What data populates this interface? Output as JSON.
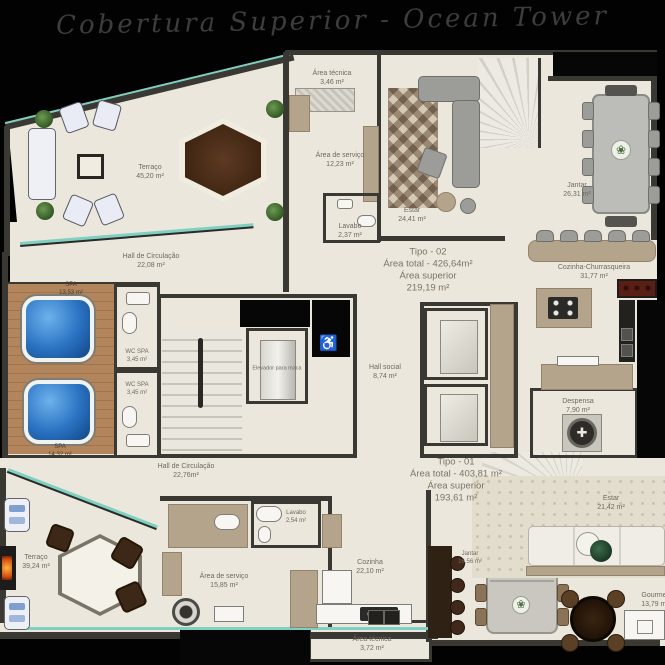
{
  "title": "Cobertura Superior - Ocean Tower",
  "colors": {
    "background": "#000000",
    "floor": "#ebe7dc",
    "wall": "#3a3833",
    "wood_deck": "#ab7c52",
    "spa_water": "#2a72c2",
    "glass": "#7fd0c0",
    "furniture_tan": "#b5a48c"
  },
  "unit_blocks": {
    "tipo02": {
      "line1": "Tipo - 02",
      "line2": "Área total - 426,64m²",
      "line3": "Área superior",
      "line4": "219,19 m²"
    },
    "tipo01": {
      "line1": "Tipo - 01",
      "line2": "Área total - 403,81 m²",
      "line3": "Área superior",
      "line4": "193,61 m²"
    }
  },
  "rooms": {
    "terraco_sup": {
      "label": "Terraço",
      "area": "45,20 m²"
    },
    "area_tecnica_sup": {
      "label": "Área técnica",
      "area": "3,46 m²"
    },
    "area_servico_sup": {
      "label": "Área de serviço",
      "area": "12,23 m²"
    },
    "lavabo_sup": {
      "label": "Lavabo",
      "area": "2,37 m²"
    },
    "estar_sup": {
      "label": "Estar",
      "area": "24,41 m²"
    },
    "jantar_sup": {
      "label": "Jantar",
      "area": "26,31 m²"
    },
    "cozinha_churrasqueira": {
      "label": "Cozinha-Churrasqueira",
      "area": "31,77 m²"
    },
    "hall_circulacao_sup": {
      "label": "Hall de Circulação",
      "area": "22,08 m²"
    },
    "spa1": {
      "label": "SPA",
      "area": "13,53 m²"
    },
    "spa2": {
      "label": "SPA",
      "area": "14,32 m²"
    },
    "wc_spa1": {
      "label": "WC SPA",
      "area": "3,45 m²"
    },
    "wc_spa2": {
      "label": "WC SPA",
      "area": "3,45 m²"
    },
    "elevador_maca": {
      "label": "Elevador para maca",
      "area": ""
    },
    "hall_social": {
      "label": "Hall social",
      "area": "8,74 m²"
    },
    "despensa": {
      "label": "Despensa",
      "area": "7,90 m²"
    },
    "hall_circulacao_inf": {
      "label": "Hall de Circulação",
      "area": "22,76m²"
    },
    "terraco_inf": {
      "label": "Terraço",
      "area": "39,24 m²"
    },
    "lavabo_inf": {
      "label": "Lavabo",
      "area": "2,54 m²"
    },
    "area_servico_inf": {
      "label": "Área de serviço",
      "area": "15,85 m²"
    },
    "cozinha_inf": {
      "label": "Cozinha",
      "area": "22,10 m²"
    },
    "jantar_inf": {
      "label": "Jantar",
      "area": "16,56 m²"
    },
    "estar_inf": {
      "label": "Estar",
      "area": "21,42 m²"
    },
    "gourmet": {
      "label": "Gourmet",
      "area": "13,79 m²"
    },
    "area_tecnica_inf": {
      "label": "Área técnica",
      "area": "3,72 m²"
    }
  }
}
